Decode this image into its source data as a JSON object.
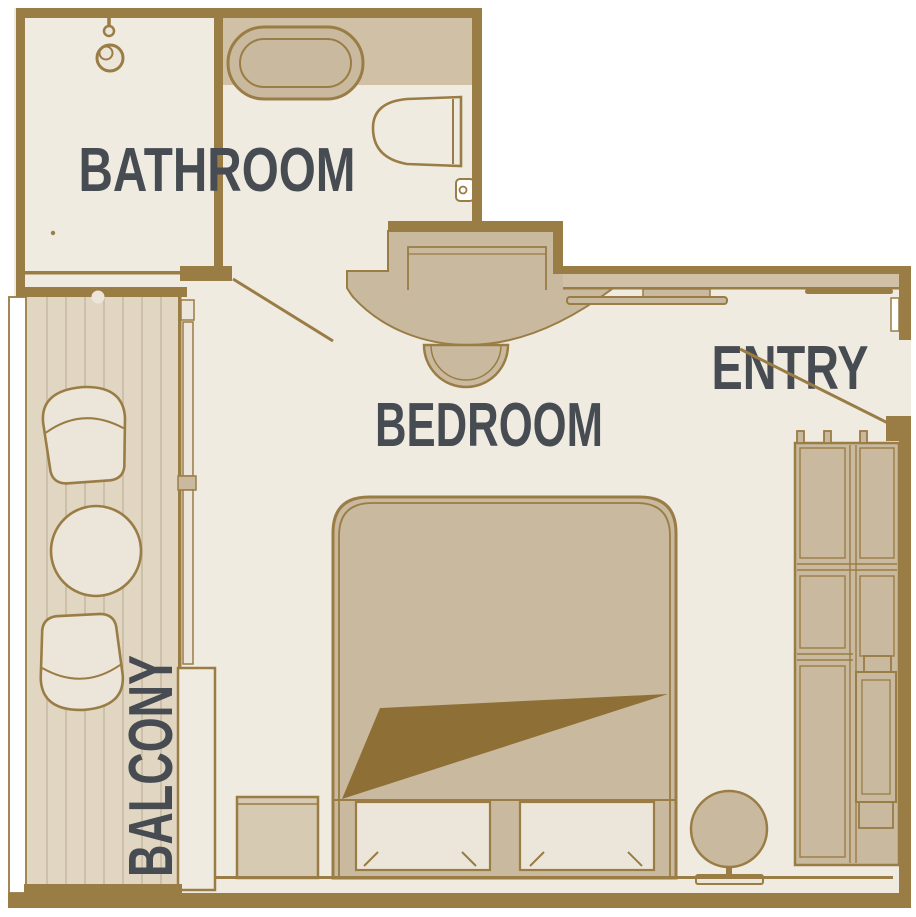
{
  "title": "Stateroom floor plan",
  "rooms": {
    "bathroom": {
      "label": "BATHROOM"
    },
    "bedroom": {
      "label": "BEDROOM"
    },
    "entry": {
      "label": "ENTRY"
    },
    "balcony": {
      "label": "BALCONY"
    }
  },
  "furniture": [
    "shower-head",
    "bathtub",
    "toilet",
    "toilet-paper-holder",
    "bathroom-door-swing",
    "vanity-desk",
    "vanity-mirror",
    "vanity-stool",
    "double-bed",
    "headboard",
    "turned-down-blanket",
    "pillow-left",
    "pillow-right",
    "nightstand",
    "pedestal-table",
    "wardrobe",
    "wardrobe-knobs",
    "ironing-board",
    "entry-door-swing",
    "luggage-shelf",
    "balcony-chair-upper",
    "balcony-chair-lower",
    "balcony-table",
    "balcony-railing",
    "balcony-decking",
    "sliding-window"
  ],
  "colors": {
    "wall_brown": "#9a7c45",
    "furniture_tan": "#c9b99e",
    "platform_tan": "#cfc0a6",
    "floor_cream": "#efebe1",
    "item_cream": "#ece6da",
    "deck": "#e0d6c2",
    "deck_plank_line": "#c8bba3",
    "blanket_dark": "#8e7036",
    "label_text": "#474c52",
    "background": "#ffffff"
  }
}
